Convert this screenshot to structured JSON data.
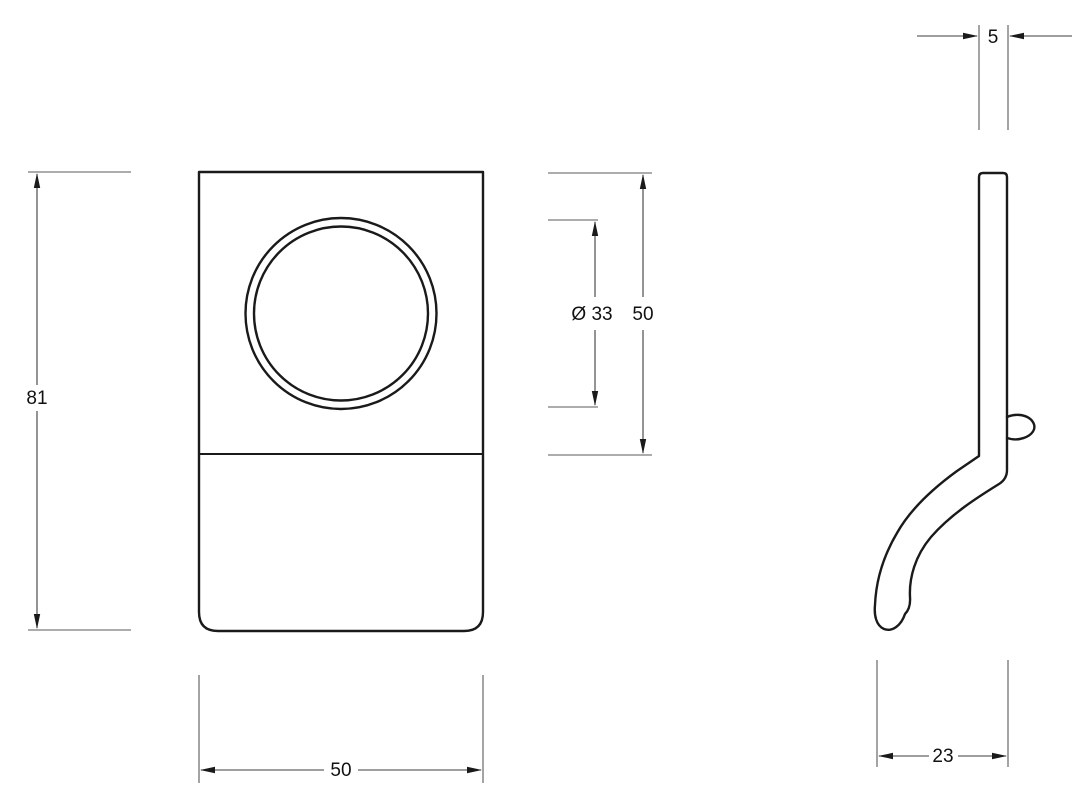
{
  "dimensions": {
    "overall_height": {
      "label": "81"
    },
    "plate_width": {
      "label": "50"
    },
    "cylinder_diameter": {
      "label": "Ø 33"
    },
    "top_section_height": {
      "label": "50"
    },
    "plate_thickness": {
      "label": "5"
    },
    "pull_depth": {
      "label": "23"
    }
  },
  "colors": {
    "background": "#ffffff",
    "object_line": "#1a1a1a",
    "dimension_line": "#5a5a5a",
    "arrow": "#1a1a1a",
    "text": "#111111"
  }
}
